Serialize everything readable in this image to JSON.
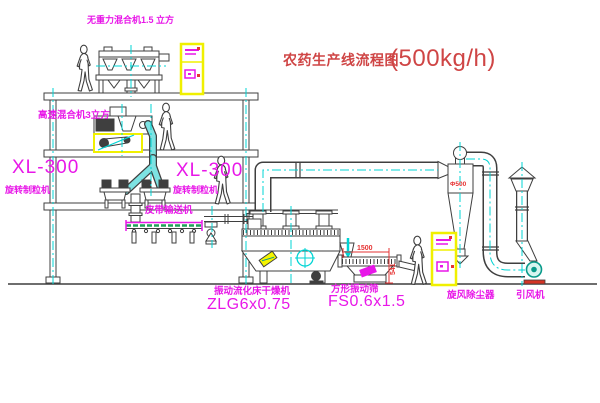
{
  "title": {
    "text": "农药生产线流程图",
    "capacity": "(500kg/h)"
  },
  "equipment_labels": {
    "gravity_mixer": "无重力混合机1.5 立方",
    "high_speed_mixer": "高速混合机3立方",
    "granulator_left": {
      "model": "XL-300",
      "name": "旋转制粒机"
    },
    "granulator_mid": {
      "model": "XL-300",
      "name": "旋转制粒机"
    },
    "belt_conveyor": "皮带输送机",
    "fluid_bed_dryer": {
      "name": "振动流化床干燥机",
      "model": "ZLG6x0.75"
    },
    "vibrating_screen": {
      "name": "方形振动筛",
      "model": "FS0.6x1.5"
    },
    "cyclone": "旋风除尘器",
    "induced_draft_fan": "引风机"
  },
  "dimensions": {
    "screen_length": "1500",
    "screen_height": "541",
    "cyclone_diameter": "Φ500"
  },
  "colors": {
    "line": "#3f3f3f",
    "centerline": "#00d4d4",
    "label_magenta": "#e817e8",
    "title_red": "#cf4545",
    "dimension_red": "#e63333",
    "cabinet_yellow": "#f0f000",
    "belt_green": "#1fa05a",
    "fan_teal": "#089a8a",
    "fan_base_red": "#d43425"
  }
}
